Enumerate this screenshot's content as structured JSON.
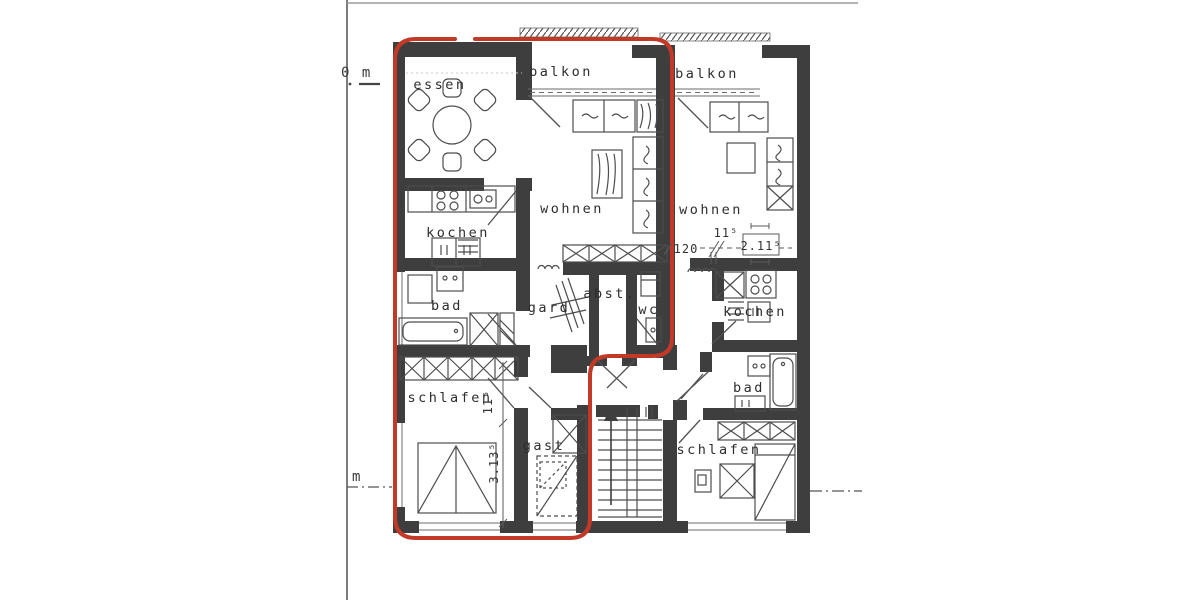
{
  "document": {
    "type": "scanned apartment floor plan",
    "colors": {
      "ink": "#3e3e3e",
      "highlight_outline": "#c23a27",
      "paper": "#ffffff"
    }
  },
  "scale_bar": {
    "top_label": "0 m",
    "bottom_label": "m"
  },
  "labels": {
    "left_unit": {
      "essen": "essen",
      "balkon": "balkon",
      "kochen": "kochen",
      "wohnen": "wohnen",
      "bad": "bad",
      "gard": "gard",
      "abst": "abst.",
      "wc": "wc",
      "schlafen": "schlafen",
      "gast": "gast"
    },
    "right_unit": {
      "balkon": "balkon",
      "wohnen": "wohnen",
      "kochen": "kochen",
      "bad": "bad",
      "schlafen": "schlafen"
    }
  },
  "dimensions": {
    "right_wohnen_a": "120",
    "right_wohnen_b": "11⁵",
    "right_wohnen_c": "2.11⁵",
    "left_schlafen_a": "11⁵",
    "left_schlafen_b": "3.13⁵"
  }
}
